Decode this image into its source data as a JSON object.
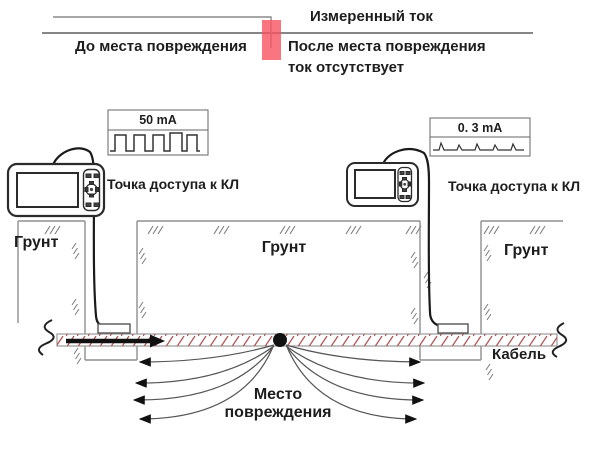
{
  "title": "Cable fault location diagram",
  "colors": {
    "fault_marker_red": "#f7525f",
    "cable_hatch_red": "#b05555",
    "diagram_line_gray": "#8a8a8a",
    "text": "#1d1d1d"
  },
  "top_graph": {
    "measured_current_label": "Измеренный ток",
    "before_fault_label": "До места повреждения",
    "after_fault_line1": "После места повреждения",
    "after_fault_line2": "ток отсутствует"
  },
  "meters": {
    "left": {
      "reading": "50 mA",
      "waveform": "square-pulses"
    },
    "right": {
      "reading": "0. 3 mA",
      "waveform": "small-spikes"
    }
  },
  "labels": {
    "access_point_left": "Точка доступа к КЛ",
    "access_point_right": "Точка доступа к КЛ",
    "ground_left": "Грунт",
    "ground_middle": "Грунт",
    "ground_right": "Грунт",
    "cable": "Кабель",
    "fault_location_line1": "Место",
    "fault_location_line2": "повреждения"
  }
}
